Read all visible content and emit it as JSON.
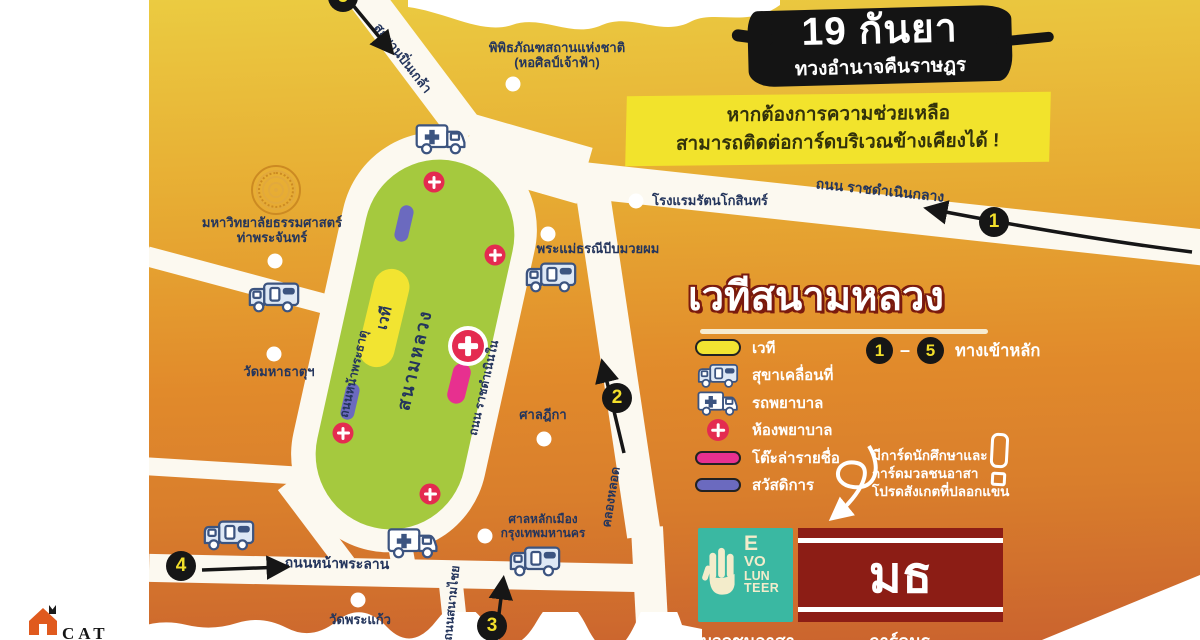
{
  "header": {
    "date_title": "19 กันยา",
    "date_subtitle": "ทวงอำนาจคืนราษฎร",
    "help_banner": {
      "line1": "หากต้องการความช่วยเหลือ",
      "line2": "สามารถติดต่อการ์ดบริเวณข้างเคียงได้ !"
    }
  },
  "panel": {
    "title": "เวทีสนามหลวง",
    "legend": [
      {
        "icon": "stage-pill-icon",
        "label": "เวที"
      },
      {
        "icon": "toilet-truck-icon",
        "label": "สุขาเคลื่อนที่"
      },
      {
        "icon": "ambulance-icon",
        "label": "รถพยาบาล"
      },
      {
        "icon": "first-aid-icon",
        "label": "ห้องพยาบาล"
      },
      {
        "icon": "signup-pill-icon",
        "label": "โต๊ะล่ารายชื่อ"
      },
      {
        "icon": "welfare-pill-icon",
        "label": "สวัสดิการ"
      }
    ],
    "entrances_legend": {
      "first": "1",
      "dash": "–",
      "last": "5",
      "label": "ทางเข้าหลัก"
    },
    "note": {
      "line1": "มีการ์ดนักศึกษาและ",
      "line2": "การ์ดมวลชนอาสา",
      "line3": "โปรดสังเกตที่ปลอกแขน",
      "icon": "exclamation-icon"
    },
    "volunteer_logo": {
      "icon": "three-finger-salute-icon",
      "lines": [
        "E",
        "VO",
        "LUN",
        "TEER"
      ],
      "caption": "มวลชนอาสา"
    },
    "armband": {
      "text": "มธ",
      "caption": "การ์ดมธ"
    }
  },
  "map": {
    "field_label": "สนามหลวง",
    "stage_label": "เวที",
    "entrances": [
      "1",
      "2",
      "3",
      "4",
      "5"
    ],
    "places": {
      "museum": [
        "พิพิธภัณฑสถานแห่งชาติ",
        "(หอศิลป์เจ้าฟ้า)"
      ],
      "thammasat": [
        "มหาวิทยาลัยธรรมศาสตร์",
        "ท่าพระจันทร์"
      ],
      "wat_mahathat": [
        "วัดมหาธาตุฯ"
      ],
      "wat_phrakaew": [
        "วัดพระแก้ว"
      ],
      "supreme_court": [
        "ศาลฎีกา"
      ],
      "city_pillar": [
        "ศาลหลักเมือง",
        "กรุงเทพมหานคร"
      ],
      "hotel": [
        "โรงแรมรัตนโกสินทร์"
      ],
      "mae_thorani": [
        "พระแม่ธรณีบีบมวยผม"
      ]
    },
    "roads": {
      "pinklao": "สะพานปิ่นเกล้า",
      "ratchadamnoen_klang": "ถนน ราชดำเนินกลาง",
      "ratchadamnoen_nai": "ถนน ราชดำเนินใน",
      "na_phra_that": "ถนนหน้าพระธาตุ",
      "na_phra_lan": "ถนนหน้าพระลาน",
      "sanam_chai": "ถนนสนามไชย",
      "khlong_lot": "คลองหลอด"
    }
  },
  "watermark": {
    "brand": "CAT"
  },
  "colors": {
    "map-orange-top": "#EBCB41",
    "map-orange-mid": "#E18A2B",
    "map-orange-bottom": "#CA632E",
    "field-green": "#A5C93E",
    "road-white": "#FCF9F0",
    "label-navy": "#24355C",
    "stage-yellow": "#F2E431",
    "signup-pink": "#E7308F",
    "welfare-purple": "#6B6ABF",
    "aid-red": "#E42B50",
    "entrance-yellow": "#F2DF2B",
    "banner-yellow": "#F2E32C",
    "armband-maroon": "#8C1D15",
    "volunteer-teal": "#3AB8A2",
    "brush-black": "#141414"
  }
}
